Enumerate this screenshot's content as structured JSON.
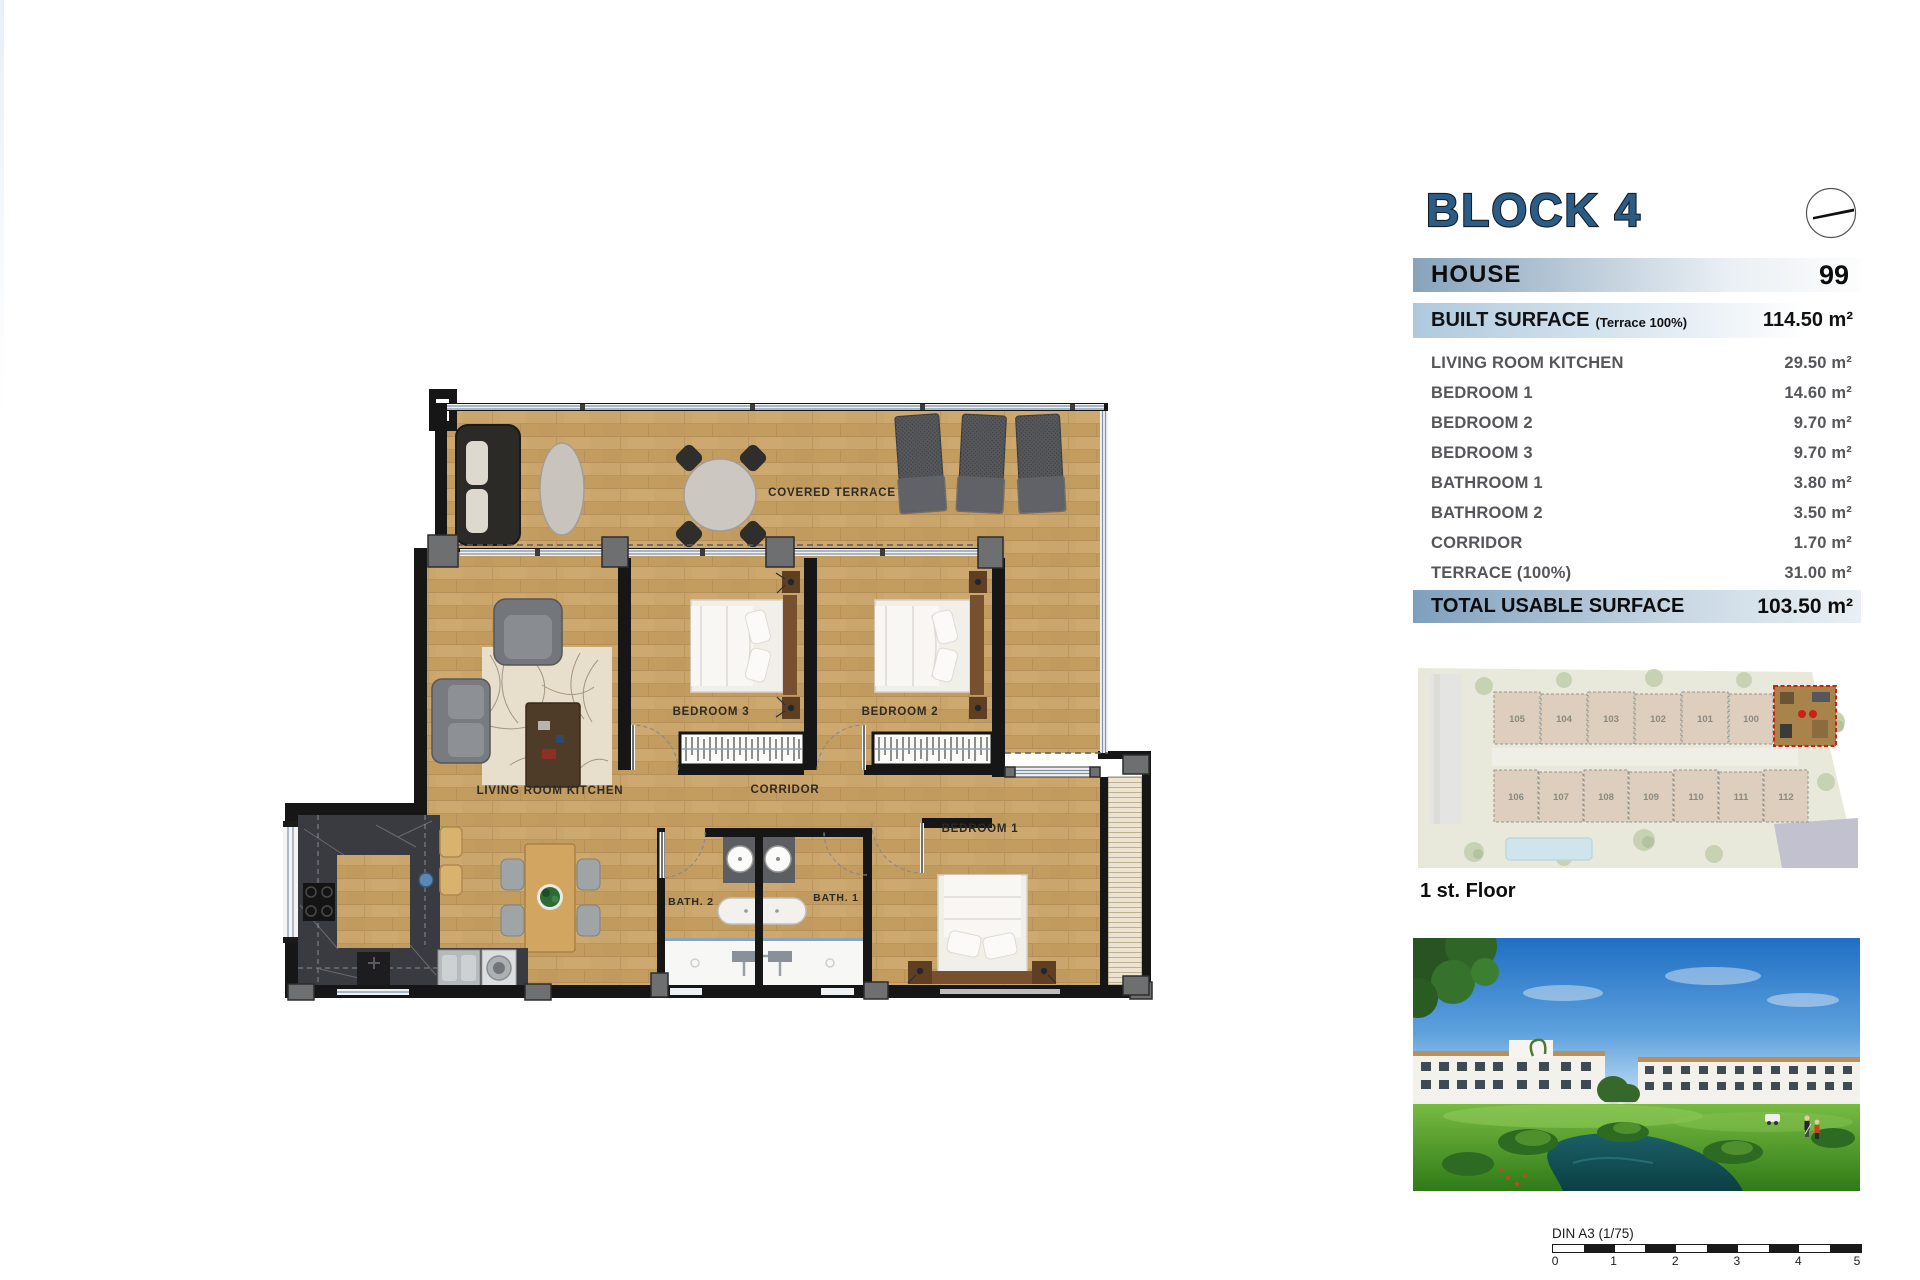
{
  "panel": {
    "block_title": "BLOCK 4",
    "house": {
      "label": "HOUSE",
      "number": "99"
    },
    "built_surface": {
      "label": "BUILT SURFACE",
      "note": "(Terrace 100%)",
      "value": "114.50 m²"
    },
    "rooms": [
      {
        "label": "LIVING ROOM KITCHEN",
        "value": "29.50 m²"
      },
      {
        "label": "BEDROOM 1",
        "value": "14.60 m²"
      },
      {
        "label": "BEDROOM 2",
        "value": "9.70 m²"
      },
      {
        "label": "BEDROOM 3",
        "value": "9.70 m²"
      },
      {
        "label": "BATHROOM 1",
        "value": "3.80 m²"
      },
      {
        "label": "BATHROOM 2",
        "value": "3.50 m²"
      },
      {
        "label": "CORRIDOR",
        "value": "1.70 m²"
      },
      {
        "label": "TERRACE (100%)",
        "value": "31.00 m²"
      }
    ],
    "total": {
      "label": "TOTAL USABLE SURFACE",
      "value": "103.50 m²"
    }
  },
  "floor_plan": {
    "labels": {
      "covered_terrace": "COVERED TERRACE",
      "living_room_kitchen": "LIVING ROOM KITCHEN",
      "bedroom3": "BEDROOM 3",
      "bedroom2": "BEDROOM 2",
      "bedroom1": "BEDROOM 1",
      "corridor": "CORRIDOR",
      "bath2": "BATH. 2",
      "bath1": "BATH. 1"
    }
  },
  "site_plan": {
    "floor_label": "1 st. Floor",
    "units_top": [
      "105",
      "104",
      "103",
      "102",
      "101",
      "100"
    ],
    "units_bottom": [
      "106",
      "107",
      "108",
      "109",
      "110",
      "111",
      "112"
    ]
  },
  "scale_bar": {
    "label": "DIN A3 (1/75)",
    "ticks": [
      "0",
      "1",
      "2",
      "3",
      "4",
      "5"
    ]
  },
  "colors": {
    "accent_blue": "#2b5c86",
    "bar_steel": "#87a3bb",
    "highlight_red": "#cc2016"
  }
}
